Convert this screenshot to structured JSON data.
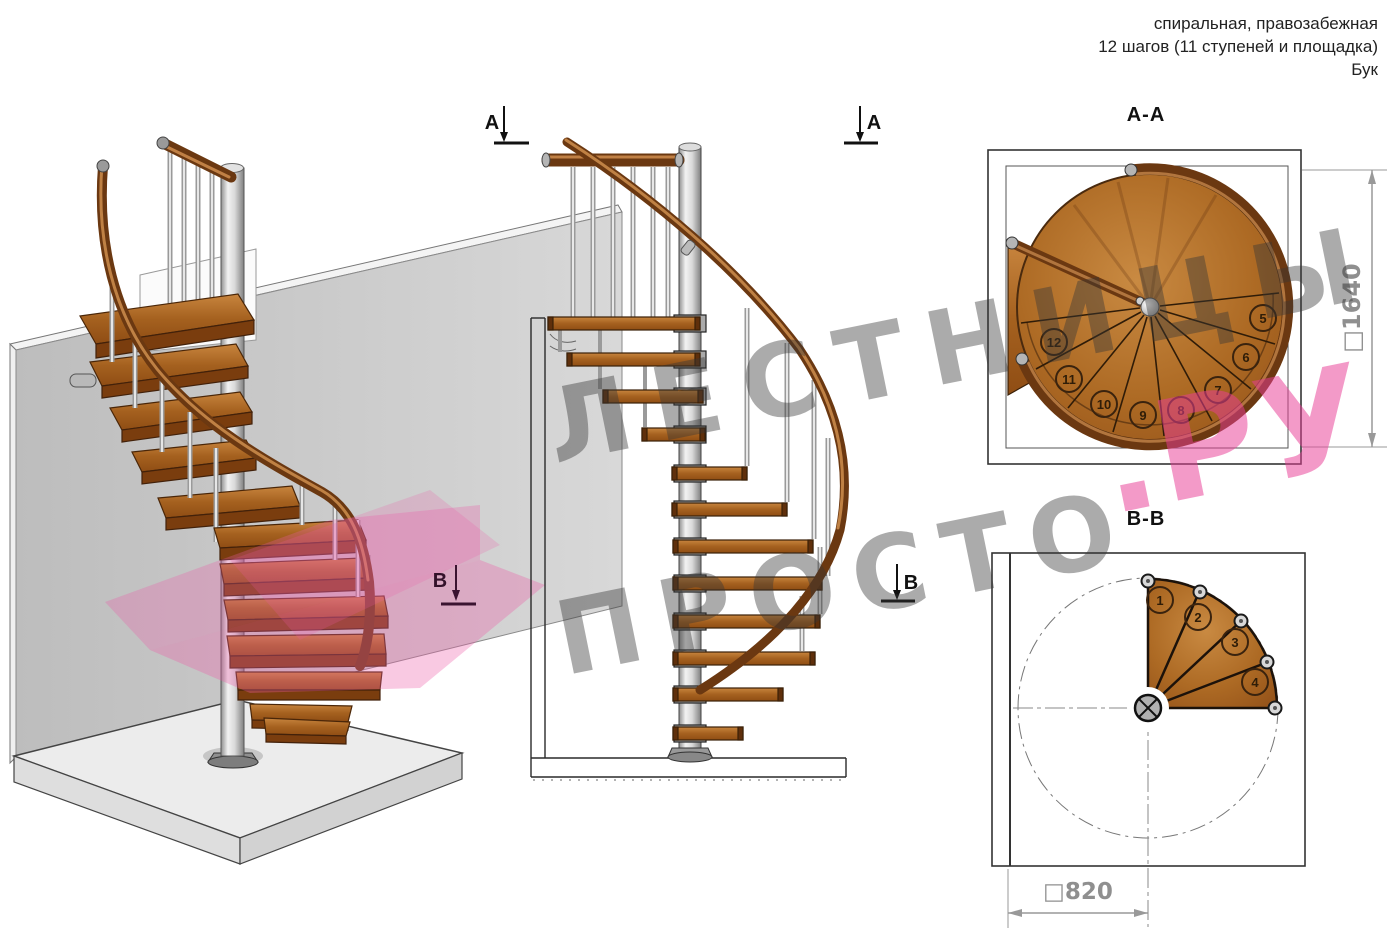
{
  "header": {
    "line1": "спиральная, правозабежная",
    "line2": "12 шагов (11 ступеней и площадка)",
    "line3": "Бук"
  },
  "sections": {
    "aa_title": "А-А",
    "bb_title": "В-В"
  },
  "markers": {
    "a": "А",
    "b": "В"
  },
  "dimensions": {
    "aa_square": "□1640",
    "bb_square": "□820"
  },
  "aa_steps": [
    "5",
    "6",
    "7",
    "8",
    "9",
    "10",
    "11",
    "12"
  ],
  "bb_steps": [
    "1",
    "2",
    "3",
    "4"
  ],
  "watermark": {
    "line1": "ЛЕСТНИЦЫ",
    "line2": "ПРОСТО",
    "suffix": ".РУ"
  },
  "colors": {
    "wood_mid": "#a8641f",
    "wood_light": "#c8853e",
    "rail_dark": "#6b3811",
    "metal": "#c9c9c9",
    "watermark_gray": "#9e9e9e",
    "watermark_pink": "#ee7ab4",
    "dim_gray": "#8f8f8f"
  }
}
